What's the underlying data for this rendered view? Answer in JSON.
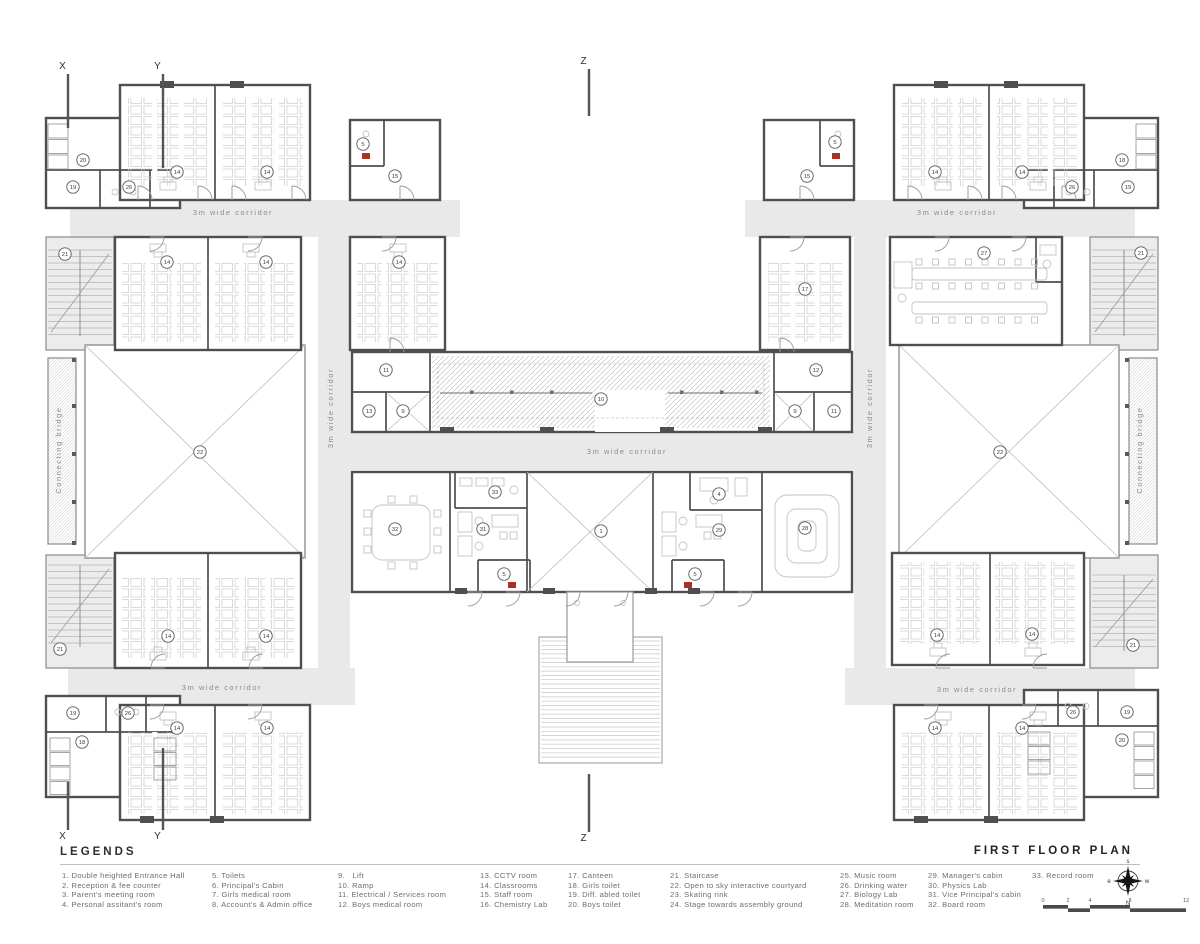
{
  "title": "FIRST FLOOR PLAN",
  "legend": {
    "heading": "LEGENDS",
    "columns": [
      {
        "x": 62,
        "items": [
          "1. Double heighted Entrance Hall",
          "2. Reception & fee counter",
          "3. Parent's meeting room",
          "4. Personal assitant's room"
        ]
      },
      {
        "x": 212,
        "items": [
          "5. Toilets",
          "6. Principal's Cabin",
          "7. Girls medical room",
          "8. Account's & Admin office"
        ]
      },
      {
        "x": 338,
        "items": [
          "9.   Lift",
          "10. Ramp",
          "11. Electrical / Services room",
          "12. Boys medical room"
        ]
      },
      {
        "x": 480,
        "items": [
          "13. CCTV room",
          "14. Classrooms",
          "15. Staff room",
          "16. Chemistry Lab"
        ]
      },
      {
        "x": 568,
        "items": [
          "17. Canteen",
          "18. Girls toilet",
          "19. Diff. abled toilet",
          "20. Boys toilet"
        ]
      },
      {
        "x": 670,
        "items": [
          "21. Staircase",
          "22. Open to sky interactive courtyard",
          "23. Skating rink",
          "24. Stage towards assembly ground"
        ]
      },
      {
        "x": 840,
        "items": [
          "25. Music room",
          "26. Drinking water",
          "27. Biology Lab",
          "28. Meditation room"
        ]
      },
      {
        "x": 928,
        "items": [
          "29. Manager's cabin",
          "30. Physics Lab",
          "31. Vice Principal's cabin",
          "32. Board room"
        ]
      },
      {
        "x": 1032,
        "items": [
          "33. Record room"
        ]
      }
    ]
  },
  "plan": {
    "corridor_label": "3m wide corridor",
    "bridge_label": "Connecting bridge",
    "corridor_labels": [
      {
        "x": 233,
        "y": 215,
        "rot": 0
      },
      {
        "x": 957,
        "y": 215,
        "rot": 0
      },
      {
        "x": 627,
        "y": 454,
        "rot": 0
      },
      {
        "x": 222,
        "y": 690,
        "rot": 0
      },
      {
        "x": 977,
        "y": 692,
        "rot": 0
      },
      {
        "x": 333,
        "y": 408,
        "rot": -90
      },
      {
        "x": 872,
        "y": 408,
        "rot": -90
      }
    ],
    "bridge_labels": [
      {
        "x": 61,
        "y": 450,
        "rot": -90
      },
      {
        "x": 1142,
        "y": 450,
        "rot": -90
      }
    ],
    "markers": [
      {
        "n": "20",
        "x": 83,
        "y": 160
      },
      {
        "n": "19",
        "x": 73,
        "y": 187
      },
      {
        "n": "26",
        "x": 129,
        "y": 187
      },
      {
        "n": "14",
        "x": 177,
        "y": 172
      },
      {
        "n": "14",
        "x": 267,
        "y": 172
      },
      {
        "n": "5",
        "x": 363,
        "y": 144
      },
      {
        "n": "15",
        "x": 395,
        "y": 176
      },
      {
        "n": "21",
        "x": 65,
        "y": 254
      },
      {
        "n": "14",
        "x": 167,
        "y": 262
      },
      {
        "n": "14",
        "x": 266,
        "y": 262
      },
      {
        "n": "14",
        "x": 399,
        "y": 262
      },
      {
        "n": "22",
        "x": 200,
        "y": 452
      },
      {
        "n": "11",
        "x": 386,
        "y": 370
      },
      {
        "n": "13",
        "x": 369,
        "y": 411
      },
      {
        "n": "9",
        "x": 403,
        "y": 411
      },
      {
        "n": "10",
        "x": 601,
        "y": 399
      },
      {
        "n": "12",
        "x": 816,
        "y": 370
      },
      {
        "n": "9",
        "x": 795,
        "y": 411
      },
      {
        "n": "11",
        "x": 834,
        "y": 411
      },
      {
        "n": "32",
        "x": 395,
        "y": 529
      },
      {
        "n": "33",
        "x": 495,
        "y": 492
      },
      {
        "n": "31",
        "x": 483,
        "y": 529
      },
      {
        "n": "5",
        "x": 504,
        "y": 574
      },
      {
        "n": "1",
        "x": 601,
        "y": 531
      },
      {
        "n": "4",
        "x": 719,
        "y": 494
      },
      {
        "n": "29",
        "x": 719,
        "y": 530
      },
      {
        "n": "5",
        "x": 695,
        "y": 574
      },
      {
        "n": "28",
        "x": 805,
        "y": 528
      },
      {
        "n": "15",
        "x": 807,
        "y": 176
      },
      {
        "n": "5",
        "x": 835,
        "y": 142
      },
      {
        "n": "14",
        "x": 935,
        "y": 172
      },
      {
        "n": "14",
        "x": 1022,
        "y": 172
      },
      {
        "n": "18",
        "x": 1122,
        "y": 160
      },
      {
        "n": "26",
        "x": 1072,
        "y": 187
      },
      {
        "n": "19",
        "x": 1128,
        "y": 187
      },
      {
        "n": "17",
        "x": 805,
        "y": 289
      },
      {
        "n": "27",
        "x": 984,
        "y": 253
      },
      {
        "n": "21",
        "x": 1141,
        "y": 253
      },
      {
        "n": "22",
        "x": 1000,
        "y": 452
      },
      {
        "n": "14",
        "x": 168,
        "y": 636
      },
      {
        "n": "14",
        "x": 266,
        "y": 636
      },
      {
        "n": "21",
        "x": 60,
        "y": 649
      },
      {
        "n": "14",
        "x": 937,
        "y": 635
      },
      {
        "n": "14",
        "x": 1032,
        "y": 634
      },
      {
        "n": "21",
        "x": 1133,
        "y": 645
      },
      {
        "n": "19",
        "x": 73,
        "y": 713
      },
      {
        "n": "26",
        "x": 128,
        "y": 713
      },
      {
        "n": "18",
        "x": 82,
        "y": 742
      },
      {
        "n": "14",
        "x": 177,
        "y": 728
      },
      {
        "n": "14",
        "x": 267,
        "y": 728
      },
      {
        "n": "26",
        "x": 1073,
        "y": 712
      },
      {
        "n": "19",
        "x": 1127,
        "y": 712
      },
      {
        "n": "20",
        "x": 1122,
        "y": 740
      },
      {
        "n": "14",
        "x": 935,
        "y": 728
      },
      {
        "n": "14",
        "x": 1022,
        "y": 728
      }
    ],
    "section_markers": [
      {
        "label": "X",
        "tx": 63,
        "ty": 69,
        "lx": 68,
        "y1": 74,
        "y2": 128
      },
      {
        "label": "Y",
        "tx": 158,
        "ty": 69,
        "lx": 163,
        "y1": 74,
        "y2": 168
      },
      {
        "label": "Z",
        "tx": 584,
        "ty": 64,
        "lx": 589,
        "y1": 69,
        "y2": 116
      },
      {
        "label": "X",
        "tx": 63,
        "ty": 839,
        "lx": 68,
        "y1": 782,
        "y2": 830
      },
      {
        "label": "Y",
        "tx": 158,
        "ty": 839,
        "lx": 163,
        "y1": 748,
        "y2": 830
      },
      {
        "label": "Z",
        "tx": 584,
        "ty": 841,
        "lx": 589,
        "y1": 774,
        "y2": 832
      }
    ],
    "compass": {
      "top": "s",
      "left": "e",
      "right": "w",
      "bottom": "N"
    },
    "scale_numbers": [
      "0",
      "2",
      "4",
      "8",
      "12"
    ],
    "colors": {
      "wall": "#4f4f4f",
      "corridor": "#e9e9e9",
      "accent_red": "#a93226",
      "furniture": "#c9c9c9"
    }
  }
}
